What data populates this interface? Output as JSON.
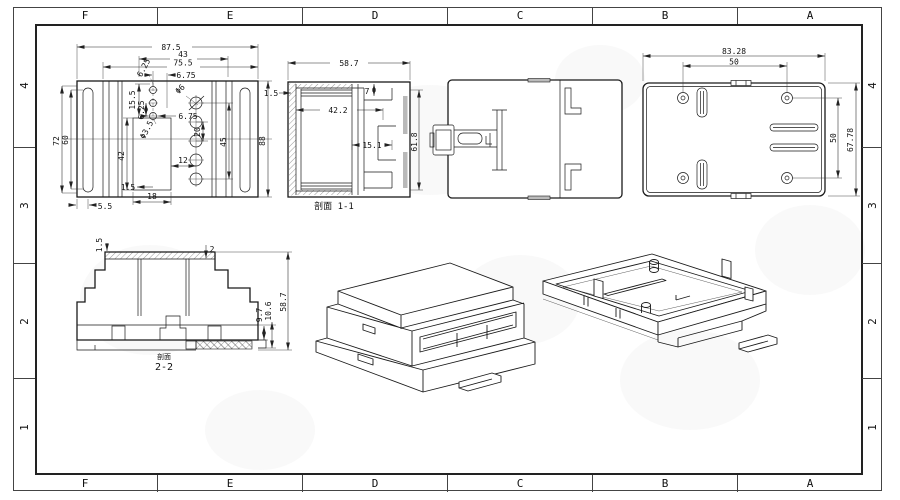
{
  "sheet": {
    "grid_columns": [
      "F",
      "E",
      "D",
      "C",
      "B",
      "A"
    ],
    "grid_rows": [
      "4",
      "3",
      "2",
      "1"
    ]
  },
  "front_view": {
    "dims": {
      "total_width": "87.5",
      "inner_width": "75.5",
      "width_43": "43",
      "offset_625": "6.25",
      "top_675": "6.75",
      "mid_675": "6.75",
      "hole_big": "Φ6",
      "hole_small": "Φ3.5",
      "v_155": "15.5",
      "v_625": "6.25",
      "recess_height": "42",
      "gap_12": "12",
      "rib_15": "1.5",
      "recess_width": "18",
      "foot_55": "5.5",
      "height_72": "72",
      "height_60": "60",
      "height_88": "88",
      "pitch_20": "20",
      "span_45": "45"
    }
  },
  "section_1_1": {
    "label": "剖面 1-1",
    "dims": {
      "width": "58.7",
      "step_7": "7",
      "inner_width": "42.2",
      "pocket": "15.1",
      "height": "61.8",
      "wall": "1.5"
    }
  },
  "back_view": {
    "dims": {
      "width": "83.28",
      "hole_span_h": "50",
      "hole_span_v": "50",
      "height": "67.78"
    }
  },
  "section_2_2": {
    "label_prefix": "剖面",
    "label": "2-2",
    "dims": {
      "wall_15": "1.5",
      "wall_2": "2",
      "height": "58.7",
      "base_97": "9.7",
      "base_106": "10.6"
    }
  }
}
